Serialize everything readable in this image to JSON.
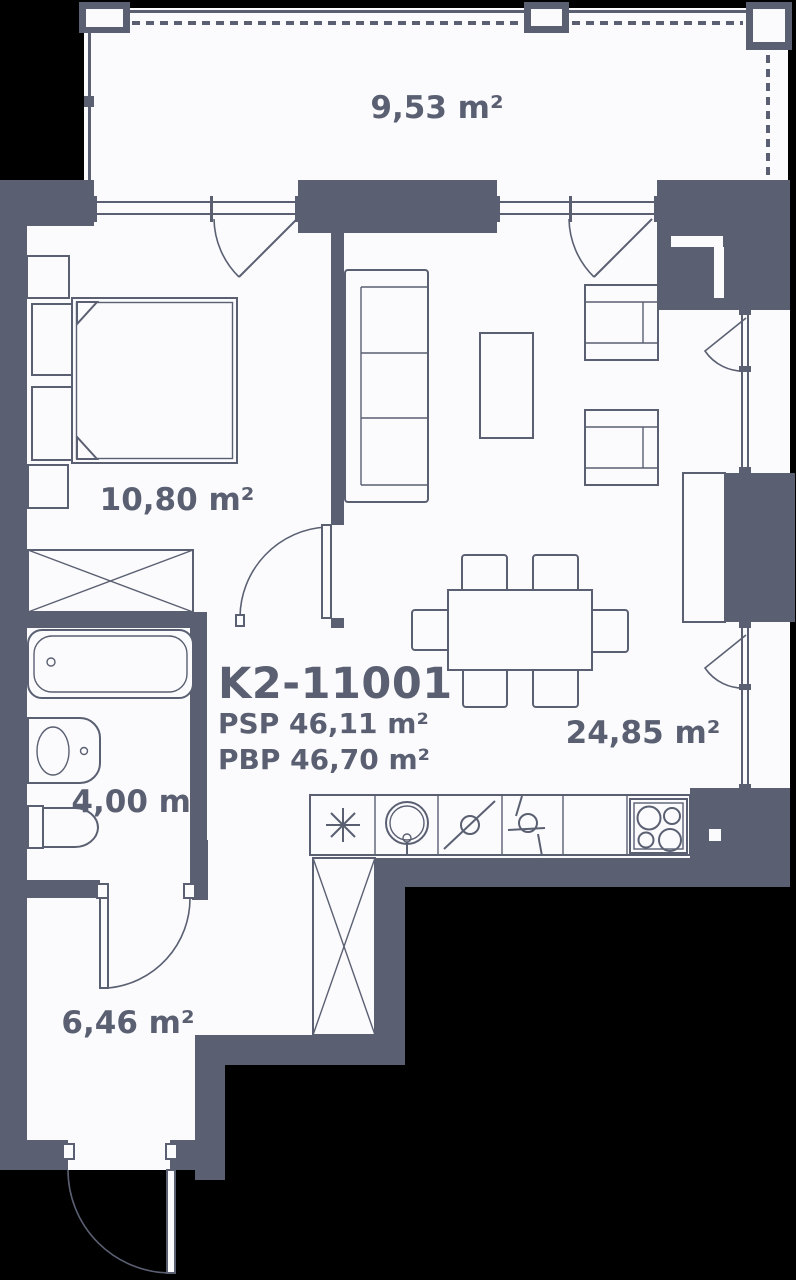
{
  "unit": {
    "id": "K2-11001",
    "psp_label": "PSP 46,11 m²",
    "pbp_label": "PBP 46,70 m²"
  },
  "rooms": [
    {
      "name": "balcony",
      "area": "9,53 m²"
    },
    {
      "name": "bedroom",
      "area": "10,80 m²"
    },
    {
      "name": "bathroom",
      "area": "4,00 m²"
    },
    {
      "name": "living-kitchen",
      "area": "24,85 m²"
    },
    {
      "name": "hallway",
      "area": "6,46 m²"
    }
  ],
  "symbols": [
    "fridge-symbol",
    "sink-symbol",
    "dishwasher-symbol",
    "washer-symbol",
    "stove-symbol",
    "wardrobe-x-symbol"
  ],
  "colors": {
    "wall": "#5a6072",
    "floor": "#fbfbfd",
    "background": "#000000"
  }
}
